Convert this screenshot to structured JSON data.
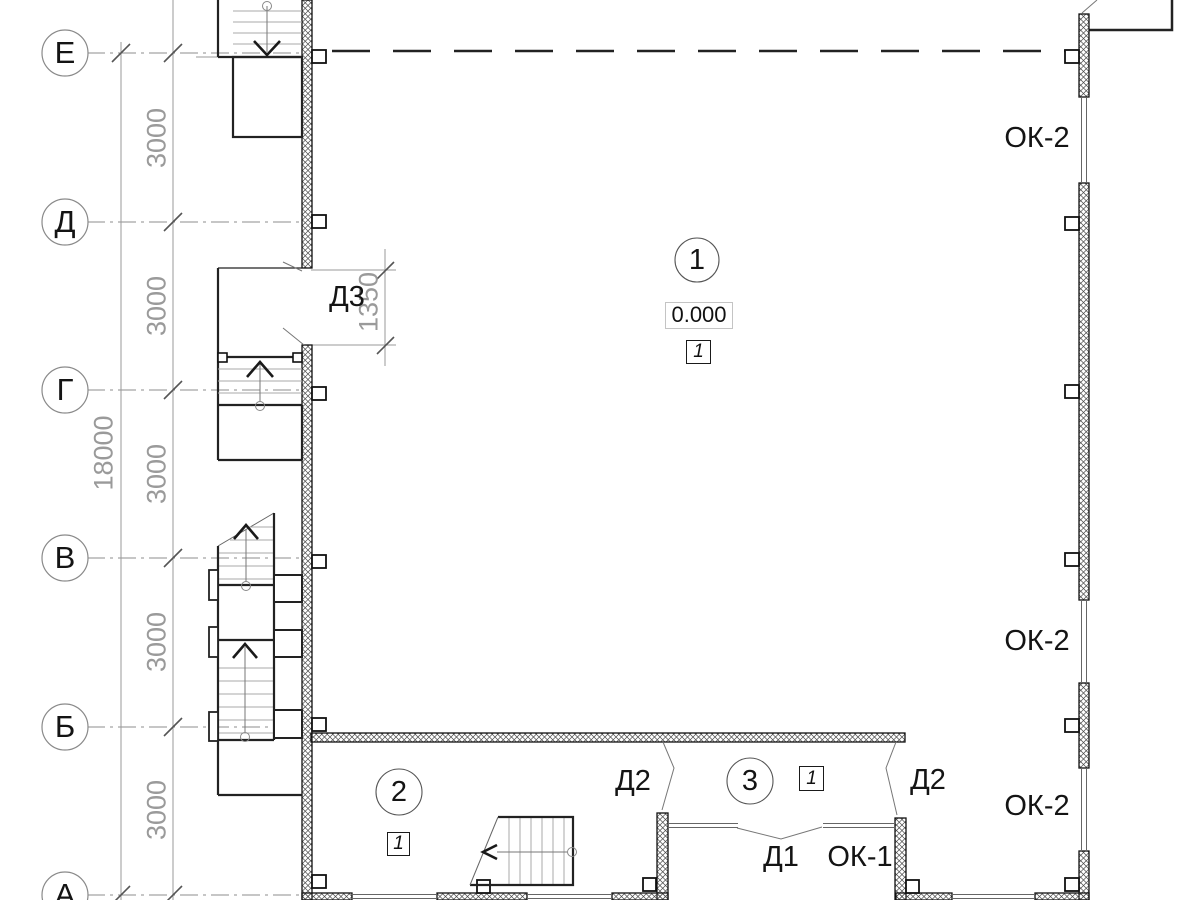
{
  "drawing": {
    "axes": [
      {
        "label": "Е"
      },
      {
        "label": "Д"
      },
      {
        "label": "Г"
      },
      {
        "label": "В"
      },
      {
        "label": "Б"
      },
      {
        "label": "А"
      }
    ],
    "dims": {
      "spans": [
        "3000",
        "3000",
        "3000",
        "3000",
        "3000"
      ],
      "total": "18000",
      "door": "1350"
    },
    "rooms": [
      {
        "number": "1",
        "level": "0.000",
        "finish": "1"
      },
      {
        "number": "2",
        "finish": "1"
      },
      {
        "number": "3",
        "finish": "1"
      }
    ],
    "openings": {
      "d3": "Д3",
      "d2_left": "Д2",
      "d2_right": "Д2",
      "d1": "Д1",
      "ok1": "ОК-1",
      "ok2_top": "ОК-2",
      "ok2_mid": "ОК-2",
      "ok2_bot": "ОК-2"
    },
    "colors": {
      "wall_line": "#1a1a1a",
      "grid_gray": "#8c8c8c",
      "dim_text": "#9a9a9a"
    }
  }
}
